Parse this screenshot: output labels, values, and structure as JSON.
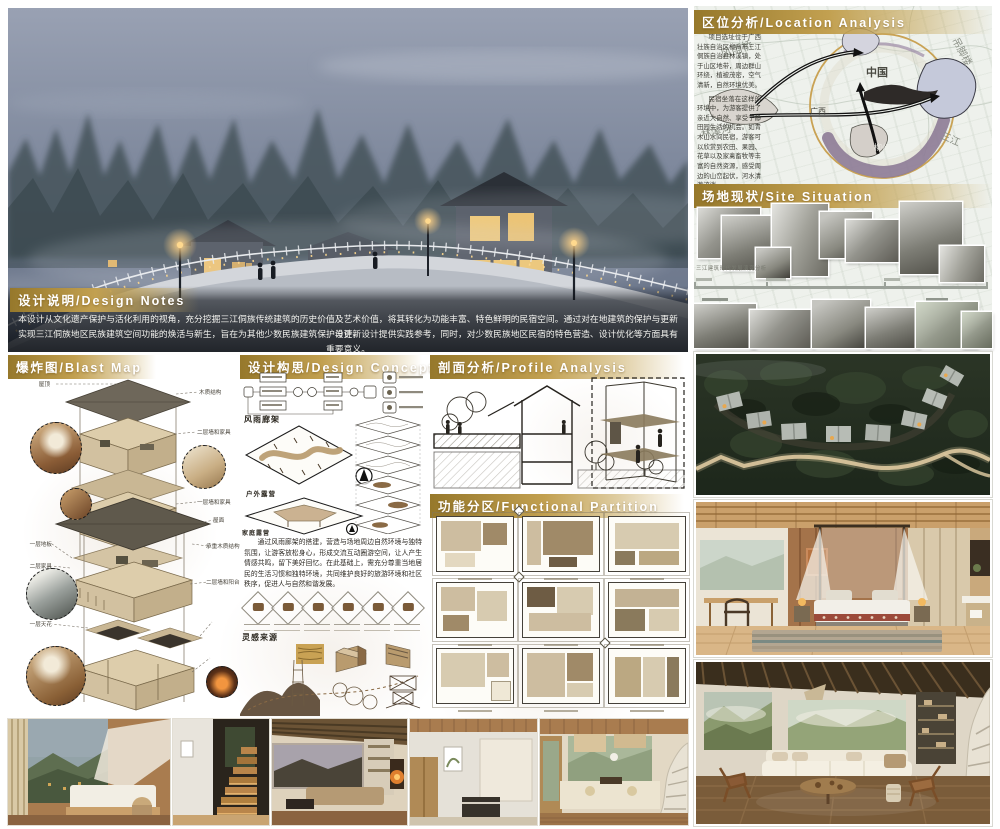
{
  "design_notes": {
    "title": "设计说明/Design Notes",
    "line1": "本设计从文化遗产保护与活化利用的视角，充分挖掘三江侗族传统建筑的历史价值及艺术价值，将其转化为功能丰富、特色鲜明的民宿空间。通过对在地建筑的保护与更新设计，",
    "line2": "实现三江侗族地区民族建筑空间功能的焕活与新生，旨在为其他少数民族建筑保护与更新设计提供实践参考，同时，对少数民族地区民宿的特色营造、设计优化等方面具有重要意义。"
  },
  "blast": {
    "title": "爆炸图/Blast Map",
    "labels": [
      "屋顶",
      "木质结构",
      "二层墙和家具",
      "一层墙和家具",
      "一层地板",
      "屋面",
      "承重木质结构",
      "二层家具",
      "二层墙和阳台",
      "卫生间",
      "一层天花",
      "一层家具"
    ]
  },
  "concept": {
    "title": "设计构思/Design Concept",
    "gallery_label": "风雨廊架",
    "camping_label": "户外露营",
    "family_label": "家庭露营",
    "paragraph": "通过风雨廊架的搭建，营造与场地周边自然环境与独特氛围，让游客放松身心，形成交流互动圈游空间，让人产生情感共鸣，留下美好回忆。在此基础上，需充分尊重当地居民的生活习惯和独特环境，共同维护良好的旅游环境和社区秩序，促进人与自然和谐发展。",
    "inspiration_label": "灵感来源"
  },
  "profile": {
    "title": "剖面分析/Profile Analysis"
  },
  "functional": {
    "title": "功能分区/Functional Partition"
  },
  "location": {
    "title": "区位分析/Location Analysis",
    "para1": "项目选址位于广西壮族自治区柳州市三江侗族自治县林溪镇，处于山区地带，周边群山环绕，植被茂密，空气清新，自然环境优美。",
    "para2": "民宿坐落在这样的环境中，为游客提供了亲近大自然、享受宁静田园生活的机会。如青木山水间民宿，游客可以欣赏到农田、果园、花草以及家禽畜牧等丰富的自然资源，感受周边的山峦起伏，河水清澈流淌。",
    "map_words": [
      "风雨桥",
      "林溪河",
      "吊脚楼",
      "中国",
      "广西",
      "柳州",
      "三江"
    ]
  },
  "site": {
    "title": "场地现状/Site Situation",
    "timeline_caption": "三江建筑时代发展演变分析"
  },
  "colors": {
    "header_gold": "#b5923c",
    "ring_gold": "#c9a254",
    "accent_purple": "#8d7b96"
  }
}
